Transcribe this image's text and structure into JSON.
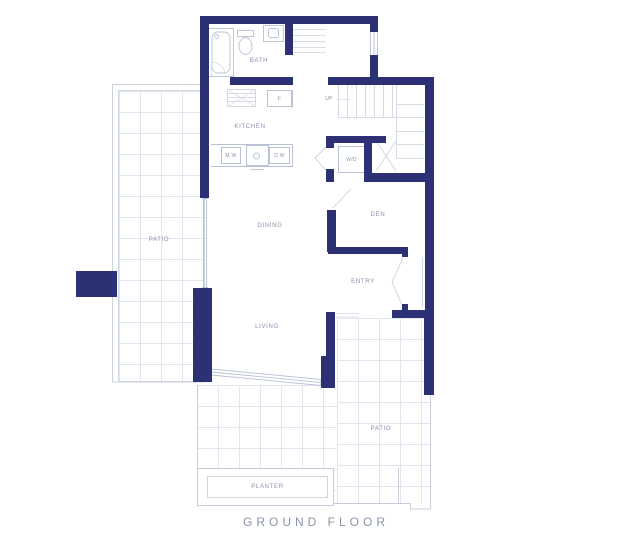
{
  "title": "GROUND FLOOR",
  "colors": {
    "wall_navy": "#2b3174",
    "line_gray": "#c2c9da",
    "grid_gray": "#e2e5ef",
    "label_gray": "#8890aa"
  },
  "labels": {
    "bath": "BATH",
    "kitchen": "KITCHEN",
    "dining": "DINING",
    "living": "LIVING",
    "den": "DEN",
    "entry": "ENTRY",
    "patio_upper": "PATIO",
    "patio_lower": "PATIO",
    "planter": "PLANTER",
    "stairs_up": "UP",
    "washer_dryer": "W/D",
    "fridge": "F",
    "microwave": "M.W",
    "dishwasher": "D.W"
  }
}
